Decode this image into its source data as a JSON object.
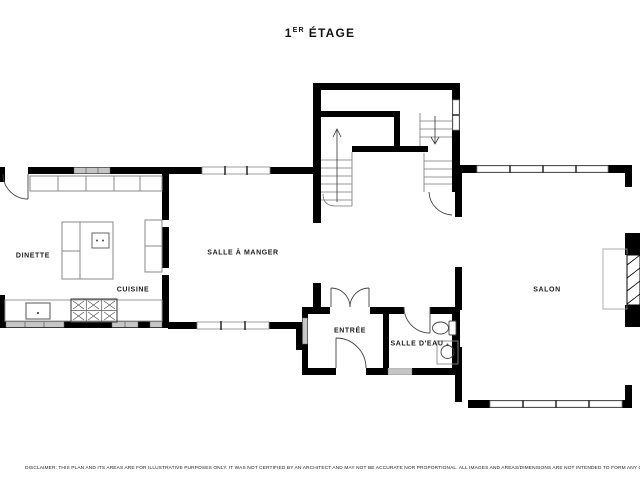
{
  "title": {
    "full": "1ER ÉTAGE",
    "number": "1",
    "ordinal": "ER",
    "word": "ÉTAGE"
  },
  "rooms": [
    {
      "name": "dinette",
      "label": "DINETTE"
    },
    {
      "name": "cuisine",
      "label": "CUISINE"
    },
    {
      "name": "salle-a-manger",
      "label": "SALLE À MANGER"
    },
    {
      "name": "entree",
      "label": "ENTRÉE"
    },
    {
      "name": "salle-d-eau",
      "label": "SALLE D'EAU"
    },
    {
      "name": "salon",
      "label": "SALON"
    }
  ],
  "fixtures": [
    "kitchen-island",
    "cooktop",
    "range-six-burners",
    "kitchen-sink",
    "upper-cabinets",
    "counter",
    "staircase-up",
    "staircase-down",
    "entry-double-door",
    "front-door",
    "interior-doors",
    "toilet",
    "washbasin",
    "fireplace",
    "windows"
  ],
  "disclaimer": "DISCLAIMER: THIS PLAN AND ITS AREAS ARE FOR ILLUSTRATIVE PURPOSES ONLY. IT WAS NOT CERTIFIED BY AN ARCHITECT AND MAY NOT BE ACCURATE NOR PROPORTIONAL. ALL IMAGES AND AREAS/DIMENSIONS ARE NOT INTENDED TO FORM ANY CONTRACT OR WARRANTY.",
  "colors": {
    "background": "#ffffff",
    "wall": "#000000",
    "window_glass": "#c6c6c6",
    "fixture_outline": "#8a8a8a",
    "text": "#1c1c1c"
  }
}
